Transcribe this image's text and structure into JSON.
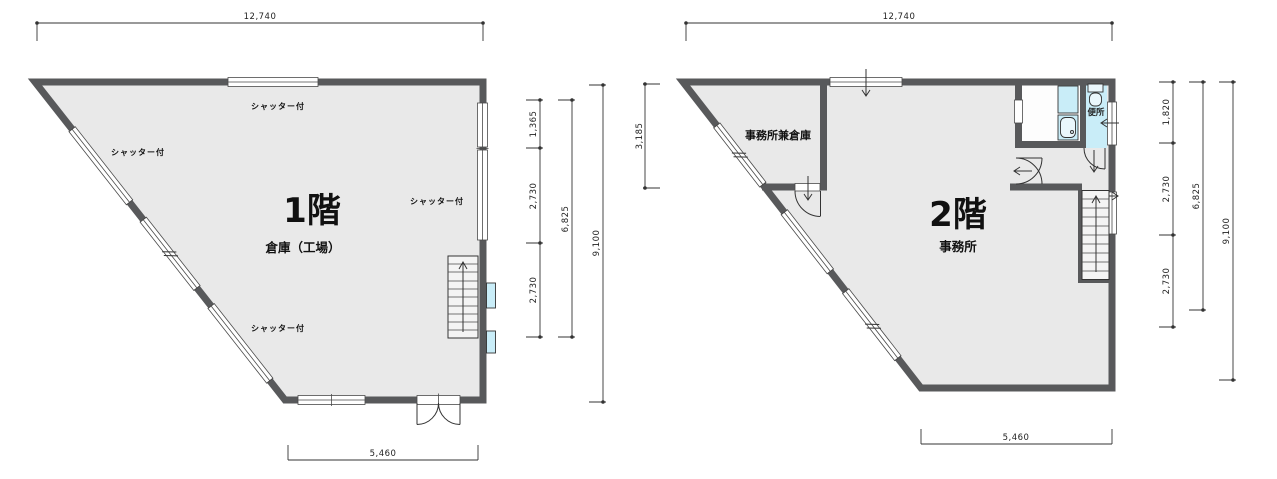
{
  "colors": {
    "wall": "#58595b",
    "floor": "#e9e9e9",
    "fixture": "#c9edf8",
    "dimension": "#333333"
  },
  "floor1": {
    "title": "1階",
    "use": "倉庫（工場）",
    "shutters": [
      "シャッター付",
      "シャッター付",
      "シャッター付",
      "シャッター付"
    ],
    "dims": {
      "top": "12,740",
      "bottom": "5,460",
      "seg1": "1,365",
      "seg2": "2,730",
      "seg3": "2,730",
      "sub": "6,825",
      "total": "9,100"
    }
  },
  "floor2": {
    "title": "2階",
    "use": "事務所",
    "storage_office": "事務所兼倉庫",
    "toilet": "便所",
    "dims": {
      "top": "12,740",
      "bottom": "5,460",
      "left": "3,185",
      "seg1": "1,820",
      "seg2": "2,730",
      "seg3": "2,730",
      "sub": "6,825",
      "total": "9,100"
    }
  }
}
